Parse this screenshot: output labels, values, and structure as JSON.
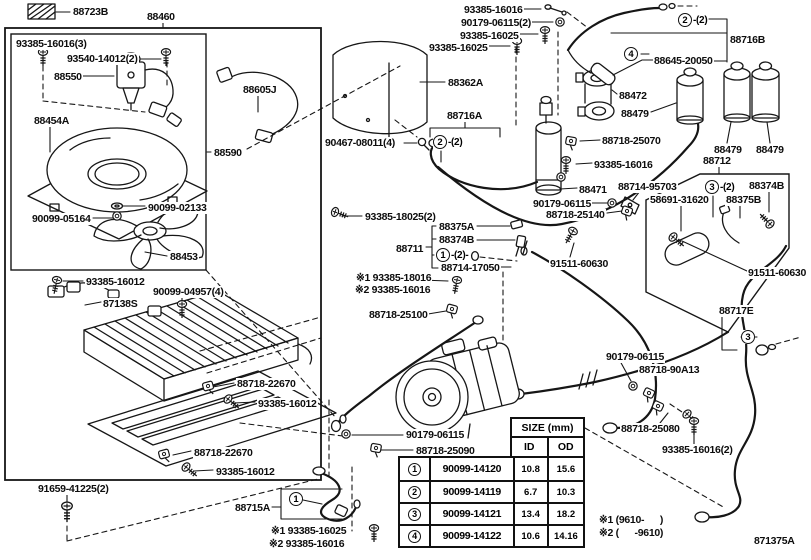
{
  "diagram": {
    "code_label": "871375A"
  },
  "colors": {
    "ink": "#161616",
    "background": "#ffffff"
  },
  "size_table": {
    "title": "SIZE (mm)",
    "col_id": "ID",
    "col_od": "OD",
    "rows": [
      {
        "no": "1",
        "part": "90099-14120",
        "id": "10.8",
        "od": "15.6"
      },
      {
        "no": "2",
        "part": "90099-14119",
        "id": "6.7",
        "od": "10.3"
      },
      {
        "no": "3",
        "part": "90099-14121",
        "id": "13.4",
        "od": "18.2"
      },
      {
        "no": "4",
        "part": "90099-14122",
        "id": "10.6",
        "od": "14.16"
      }
    ]
  },
  "part_labels": [
    {
      "text": "88723B",
      "x": 72,
      "y": 6
    },
    {
      "text": "88460",
      "x": 146,
      "y": 11
    },
    {
      "text": "93385-16016(3)",
      "x": 15,
      "y": 38
    },
    {
      "text": "93540-14012(2)",
      "x": 66,
      "y": 53
    },
    {
      "text": "88550",
      "x": 53,
      "y": 71
    },
    {
      "text": "88454A",
      "x": 33,
      "y": 115
    },
    {
      "text": "88605J",
      "x": 242,
      "y": 84
    },
    {
      "text": "88590",
      "x": 213,
      "y": 147
    },
    {
      "text": "90099-02133",
      "x": 147,
      "y": 202
    },
    {
      "text": "90099-05164",
      "x": 31,
      "y": 213
    },
    {
      "text": "88453",
      "x": 169,
      "y": 251
    },
    {
      "text": "93385-16012",
      "x": 85,
      "y": 276
    },
    {
      "text": "90099-04957(4)",
      "x": 152,
      "y": 286
    },
    {
      "text": "87138S",
      "x": 102,
      "y": 298
    },
    {
      "text": "88718-22670",
      "x": 236,
      "y": 378
    },
    {
      "text": "93385-16012",
      "x": 257,
      "y": 398
    },
    {
      "text": "88718-22670",
      "x": 193,
      "y": 447
    },
    {
      "text": "93385-16012",
      "x": 215,
      "y": 466
    },
    {
      "text": "91659-41225(2)",
      "x": 37,
      "y": 483
    },
    {
      "text": "88715A",
      "x": 234,
      "y": 502
    },
    {
      "text": "※1 93385-16025",
      "x": 270,
      "y": 525
    },
    {
      "text": "※2 93385-16016",
      "x": 268,
      "y": 538
    },
    {
      "text": "93385-16016",
      "x": 463,
      "y": 4
    },
    {
      "text": "90179-06115(2)",
      "x": 460,
      "y": 17
    },
    {
      "text": "93385-16025",
      "x": 459,
      "y": 30
    },
    {
      "text": "93385-16025",
      "x": 428,
      "y": 42
    },
    {
      "text": "88362A",
      "x": 447,
      "y": 77
    },
    {
      "text": "88716A",
      "x": 446,
      "y": 110
    },
    {
      "text": "90467-08011(4)",
      "x": 324,
      "y": 137
    },
    {
      "text": "93385-18025(2)",
      "x": 364,
      "y": 211
    },
    {
      "text": "88375A",
      "x": 438,
      "y": 221
    },
    {
      "text": "88374B",
      "x": 438,
      "y": 234
    },
    {
      "text": "88711",
      "x": 395,
      "y": 243
    },
    {
      "text": "88714-17050",
      "x": 440,
      "y": 262
    },
    {
      "text": "91511-60630",
      "x": 549,
      "y": 258
    },
    {
      "text": "※1 93385-18016",
      "x": 355,
      "y": 272
    },
    {
      "text": "※2 93385-16016",
      "x": 354,
      "y": 284
    },
    {
      "text": "88718-25100",
      "x": 368,
      "y": 309
    },
    {
      "text": "90179-06115",
      "x": 405,
      "y": 429
    },
    {
      "text": "88718-25090",
      "x": 415,
      "y": 445
    },
    {
      "text": "88716B",
      "x": 729,
      "y": 34
    },
    {
      "text": "88645-20050",
      "x": 653,
      "y": 55
    },
    {
      "text": "88472",
      "x": 618,
      "y": 90
    },
    {
      "text": "88479",
      "x": 620,
      "y": 108
    },
    {
      "text": "88718-25070",
      "x": 601,
      "y": 135
    },
    {
      "text": "93385-16016",
      "x": 593,
      "y": 159
    },
    {
      "text": "88471",
      "x": 578,
      "y": 184
    },
    {
      "text": "88479",
      "x": 713,
      "y": 144
    },
    {
      "text": "88479",
      "x": 755,
      "y": 144
    },
    {
      "text": "88712",
      "x": 702,
      "y": 155
    },
    {
      "text": "88714-95703",
      "x": 617,
      "y": 181
    },
    {
      "text": "88374B",
      "x": 748,
      "y": 180
    },
    {
      "text": "58691-31620",
      "x": 649,
      "y": 194
    },
    {
      "text": "88375B",
      "x": 725,
      "y": 194
    },
    {
      "text": "90179-06115",
      "x": 532,
      "y": 198
    },
    {
      "text": "88718-25140",
      "x": 545,
      "y": 209
    },
    {
      "text": "91511-60630",
      "x": 747,
      "y": 267
    },
    {
      "text": "88717E",
      "x": 718,
      "y": 305
    },
    {
      "text": "90179-06115",
      "x": 605,
      "y": 351
    },
    {
      "text": "88718-90A13",
      "x": 638,
      "y": 364
    },
    {
      "text": "88718-25080",
      "x": 620,
      "y": 423
    },
    {
      "text": "93385-16016(2)",
      "x": 661,
      "y": 444
    },
    {
      "text": "※1 (9610-      )",
      "x": 598,
      "y": 514
    },
    {
      "text": "※2 (      -9610)",
      "x": 598,
      "y": 527
    },
    {
      "text": "871375A",
      "x": 753,
      "y": 535
    }
  ],
  "circled_markers": [
    {
      "n": "2",
      "suffix": "-(2)",
      "x": 433,
      "y": 135
    },
    {
      "n": "1",
      "suffix": "-(2)-",
      "x": 436,
      "y": 248
    },
    {
      "n": "1",
      "suffix": "",
      "x": 289,
      "y": 492
    },
    {
      "n": "2",
      "suffix": "-(2)",
      "x": 678,
      "y": 13
    },
    {
      "n": "4",
      "suffix": "",
      "x": 624,
      "y": 47
    },
    {
      "n": "3",
      "suffix": "-(2)",
      "x": 705,
      "y": 180
    },
    {
      "n": "3",
      "suffix": "",
      "x": 741,
      "y": 330
    }
  ]
}
